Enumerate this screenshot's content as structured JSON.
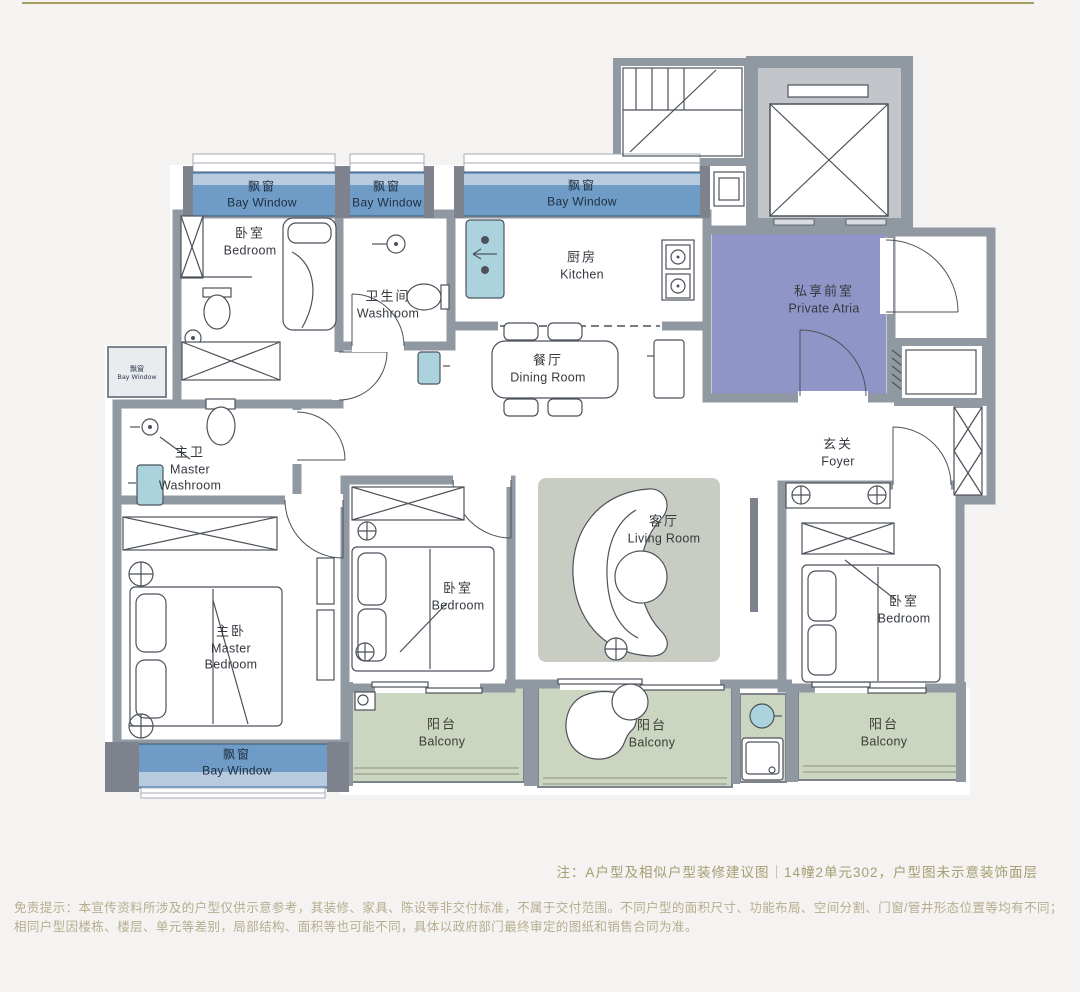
{
  "colors": {
    "page_bg": "#f4f3f1",
    "accent": "#a89e63",
    "wall": "#9098a2",
    "wall_dark": "#7d828c",
    "line": "#4c525a",
    "floor": "#ffffff",
    "bay_dark": "#6e9cc6",
    "bay_light": "#b7cbdf",
    "balcony": "#ccd5bf",
    "atria": "#9095c7",
    "rug": "#c8ccc2",
    "fixture_blue": "#abd3de",
    "railing": "#8b9183",
    "label_text": "#34393f",
    "bay_text": "#1f2d3f",
    "note_text": "#a79d72",
    "disclaimer_text": "#b6ad8f"
  },
  "rooms": {
    "bay_nw": {
      "zh": "飘窗",
      "en": "Bay Window"
    },
    "bedroom_nw": {
      "zh": "卧室",
      "en": "Bedroom"
    },
    "bay_n": {
      "zh": "飘窗",
      "en": "Bay Window"
    },
    "washroom": {
      "zh": "卫生间",
      "en": "Washroom"
    },
    "bay_kitchen": {
      "zh": "飘窗",
      "en": "Bay Window"
    },
    "kitchen": {
      "zh": "厨房",
      "en": "Kitchen"
    },
    "dining": {
      "zh": "餐厅",
      "en": "Dining Room"
    },
    "private_atria": {
      "zh": "私享前室",
      "en": "Private Atria"
    },
    "foyer": {
      "zh": "玄关",
      "en": "Foyer"
    },
    "bay_small": {
      "zh": "飘窗",
      "en": "Bay Window"
    },
    "master_washroom": {
      "zh": "主卫",
      "en": "Master Washroom"
    },
    "master_bedroom": {
      "zh": "主卧",
      "en": "Master Bedroom"
    },
    "bedroom_c": {
      "zh": "卧室",
      "en": "Bedroom"
    },
    "living": {
      "zh": "客厅",
      "en": "Living Room"
    },
    "bedroom_e": {
      "zh": "卧室",
      "en": "Bedroom"
    },
    "balcony_w": {
      "zh": "阳台",
      "en": "Balcony"
    },
    "balcony_c": {
      "zh": "阳台",
      "en": "Balcony"
    },
    "balcony_e": {
      "zh": "阳台",
      "en": "Balcony"
    },
    "bay_master": {
      "zh": "飘窗",
      "en": "Bay Window"
    }
  },
  "footer": {
    "note": "注：A户型及相似户型装修建议图｜14幢2单元302，户型图未示意装饰面层",
    "disclaimer": "免责提示：本宣传资料所涉及的户型仅供示意参考，其装修、家具、陈设等非交付标准，不属于交付范围。不同户型的面积尺寸、功能布局、空间分割、门窗/管井形态位置等均有不同；相同户型因楼栋、楼层、单元等差别，局部结构、面积等也可能不同，具体以政府部门最终审定的图纸和销售合同为准。"
  }
}
